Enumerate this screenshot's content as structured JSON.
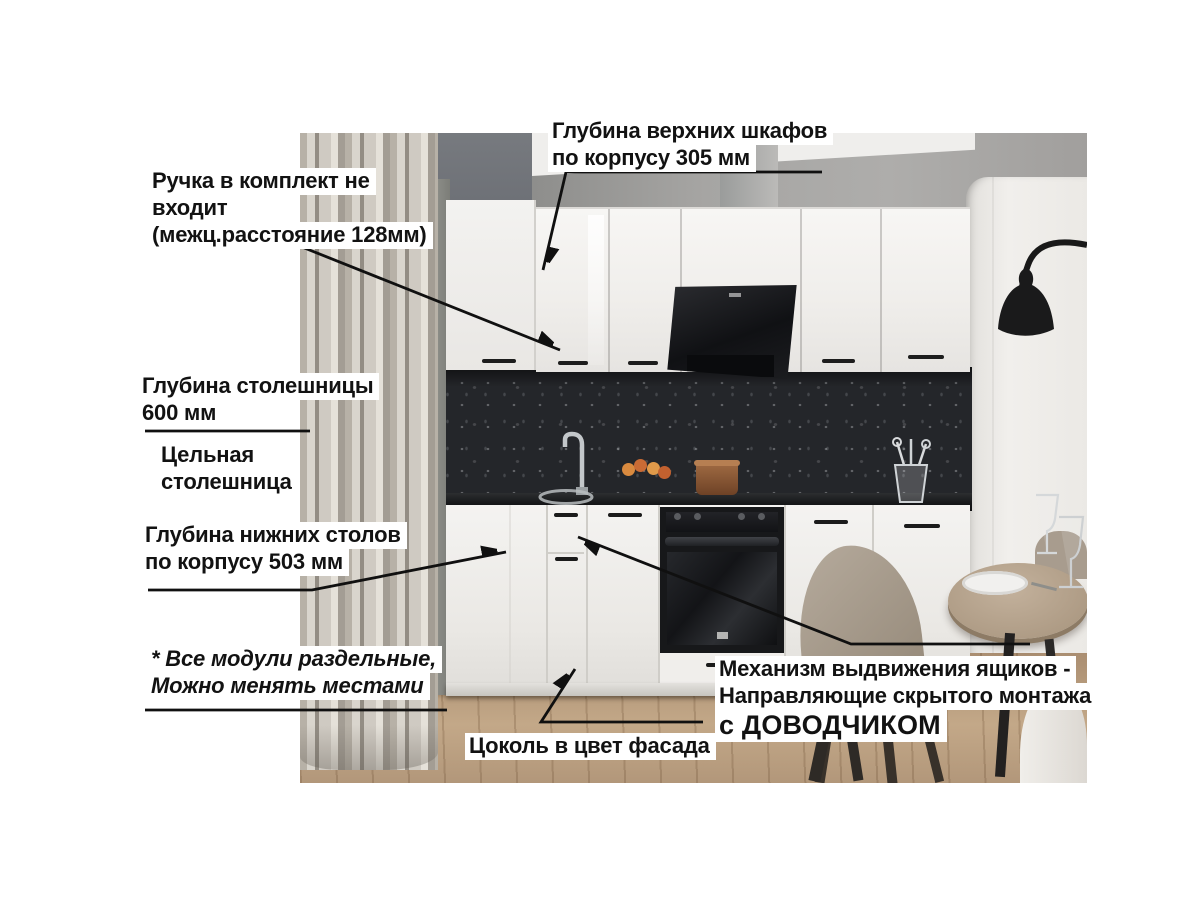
{
  "annotations": {
    "upper_depth": {
      "lines": [
        "Глубина верхних шкафов",
        " по корпусу 305 мм"
      ]
    },
    "handle_note": {
      "lines": [
        "Ручка в комплект не",
        "входит",
        "(межц.расстояние 128мм)"
      ]
    },
    "counter_depth": {
      "lines": [
        "Глубина столешницы",
        " 600 мм"
      ]
    },
    "solid_top": {
      "lines": [
        "Цельная",
        "столешница"
      ]
    },
    "base_depth": {
      "lines": [
        "Глубина нижних столов",
        "по корпусу 503 мм"
      ]
    },
    "modules_note": {
      "lines": [
        "* Все модули раздельные,",
        " Можно менять местами"
      ]
    },
    "plinth_note": {
      "lines": [
        "Цоколь в цвет фасада"
      ]
    },
    "drawer_mech": {
      "lines": [
        "Механизм выдвижения ящиков -",
        "Направляющие скрытого монтажа",
        "с ДОВОДЧИКОМ"
      ]
    }
  },
  "colors": {
    "page_background": "#ffffff",
    "annotation_text": "#121212",
    "highlight_background": "#ffffff",
    "annotation_line": "#101010",
    "cabinet_white": "#f2f1ef",
    "backsplash_granite": "#24262a",
    "countertop_dark": "#17181a",
    "appliance_black": "#17181a",
    "wall_gray": "#a3a2a0",
    "curtain_beige": "#c9c4bb",
    "floor_wood": "#b3977a",
    "table_wood": "#b09d87",
    "chair_taupe": "#a89c8e"
  }
}
